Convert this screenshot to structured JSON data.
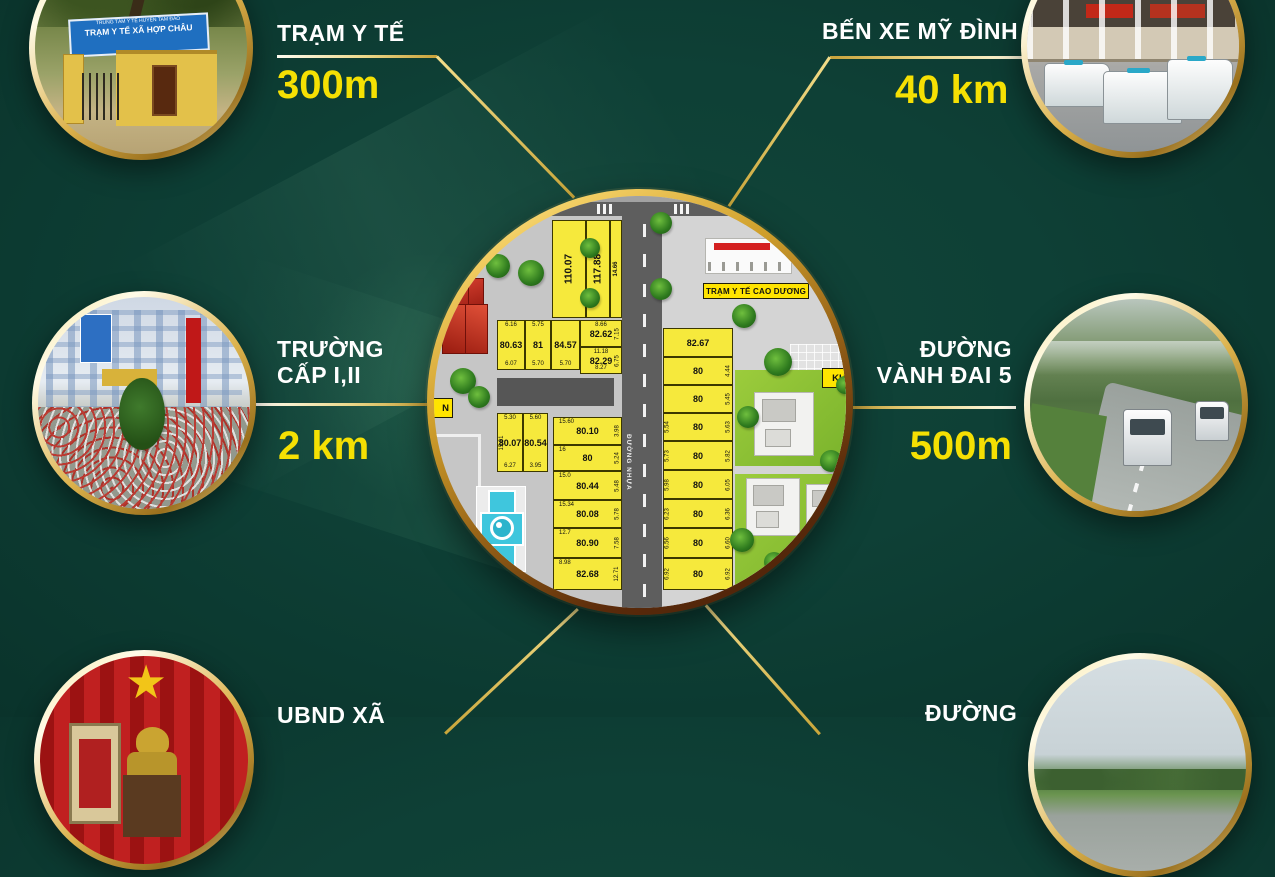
{
  "callouts": {
    "health_station": {
      "title": "TRẠM Y TẾ",
      "distance": "300m",
      "photo_sign_line1": "TRUNG TÂM Y TẾ HUYỆN TAM ĐẢO",
      "photo_sign_line2": "TRẠM Y TẾ XÃ HỢP CHÂU"
    },
    "bus_station": {
      "title": "BẾN XE MỸ ĐÌNH",
      "distance": "40 km"
    },
    "school": {
      "title_line1": "TRƯỜNG",
      "title_line2": "CẤP I,II",
      "distance": "2 km"
    },
    "ring_road": {
      "title_line1": "ĐƯỜNG",
      "title_line2": "VÀNH ĐAI 5",
      "distance": "500m"
    },
    "commune_hall": {
      "title": "UBND XÃ"
    },
    "road_bottom": {
      "title": "ĐƯỜNG"
    }
  },
  "map": {
    "health_station_label": "TRẠM Y TẾ CAO DƯƠNG",
    "road_label": "ĐƯỜNG NHỰA",
    "partial_label_right": "KH",
    "partial_label_left": "N",
    "plot_groups": {
      "tall": [
        {
          "value": "110.07"
        },
        {
          "value": "117.88"
        },
        {
          "value": "14.66"
        }
      ],
      "row1": [
        {
          "value": "80.63",
          "top": "6.16",
          "bottom": "6.07"
        },
        {
          "value": "81",
          "top": "5.75",
          "bottom": "5.70"
        },
        {
          "value": "84.57",
          "bottom": "5.70"
        },
        {
          "value": "82.62",
          "top": "8.66",
          "right": "7.15"
        },
        {
          "value": "82.29",
          "top": "11.18",
          "right": "6.75",
          "bottom": "8.27"
        }
      ],
      "row2": [
        {
          "value": "80.07",
          "top": "5.30",
          "left": "15.01",
          "bottom": "6.27"
        },
        {
          "value": "80.54",
          "top": "5.60",
          "bottom": "3.95"
        }
      ],
      "col_mid": [
        {
          "value": "80.10",
          "top": "15.60",
          "right": "3.98"
        },
        {
          "value": "80",
          "top": "16",
          "right": "5.24"
        },
        {
          "value": "80.44",
          "top": "15.0",
          "right": "5.48"
        },
        {
          "value": "80.08",
          "top": "15.34",
          "right": "5.78"
        },
        {
          "value": "80.90",
          "top": "12.7",
          "right": "7.58"
        },
        {
          "value": "82.68",
          "top": "8.98",
          "right": "12.71"
        }
      ],
      "col_right": [
        {
          "value": "82.67"
        },
        {
          "value": "80",
          "right": "4.44"
        },
        {
          "value": "80",
          "right": "5.45"
        },
        {
          "value": "80",
          "left": "5.54",
          "right": "5.63"
        },
        {
          "value": "80",
          "left": "5.73",
          "right": "5.82"
        },
        {
          "value": "80",
          "left": "5.98",
          "right": "6.05"
        },
        {
          "value": "80",
          "left": "6.23",
          "right": "6.36"
        },
        {
          "value": "80",
          "left": "6.56",
          "right": "6.60"
        },
        {
          "value": "80",
          "left": "6.92",
          "right": "6.92"
        }
      ]
    }
  },
  "colors": {
    "background": "#0e4036",
    "accent_gold": "#d9b24a",
    "distance_yellow": "#f5e003",
    "plot_yellow": "#f6e93c",
    "map_label_yellow": "#ffe400"
  }
}
